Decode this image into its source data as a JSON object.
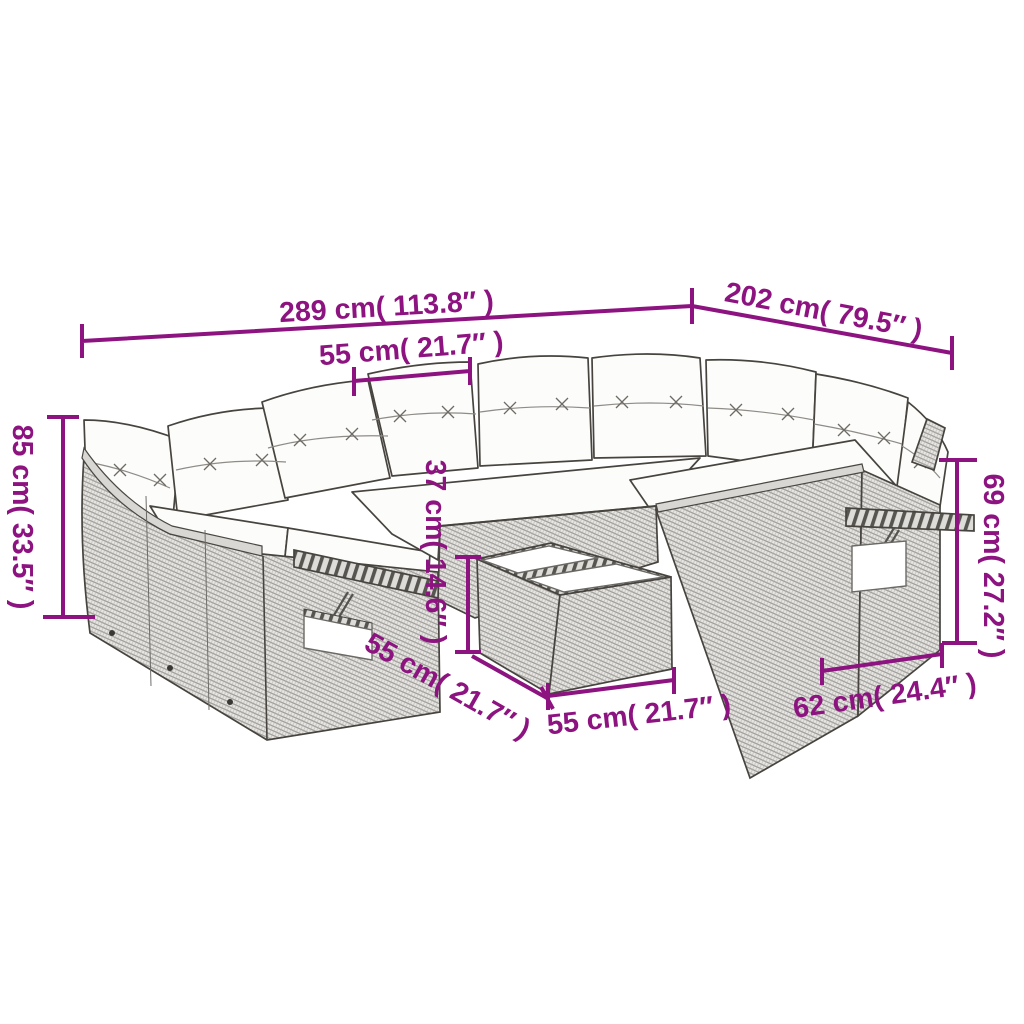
{
  "diagram": {
    "subject": "rattan garden lounge furniture set with cushions and table, dimension diagram",
    "accent_color": "#8C1380",
    "furniture_fill": "#E7E6E3",
    "outline_color": "#47443F",
    "cushion_color": "#FCFCFA",
    "dimensions": {
      "back_total_width": "289 cm( 113.8″ )",
      "right_side_depth": "202 cm( 79.5″ )",
      "seat_module_width": "55 cm( 21.7″ )",
      "overall_height": "85 cm( 33.5″ )",
      "armrest_height": "69 cm( 27.2″ )",
      "table_height": "37 cm( 14.6″ )",
      "table_depth": "55 cm( 21.7″ )",
      "table_width": "55 cm( 21.7″ )",
      "end_module_depth": "62 cm( 24.4″ )"
    }
  }
}
